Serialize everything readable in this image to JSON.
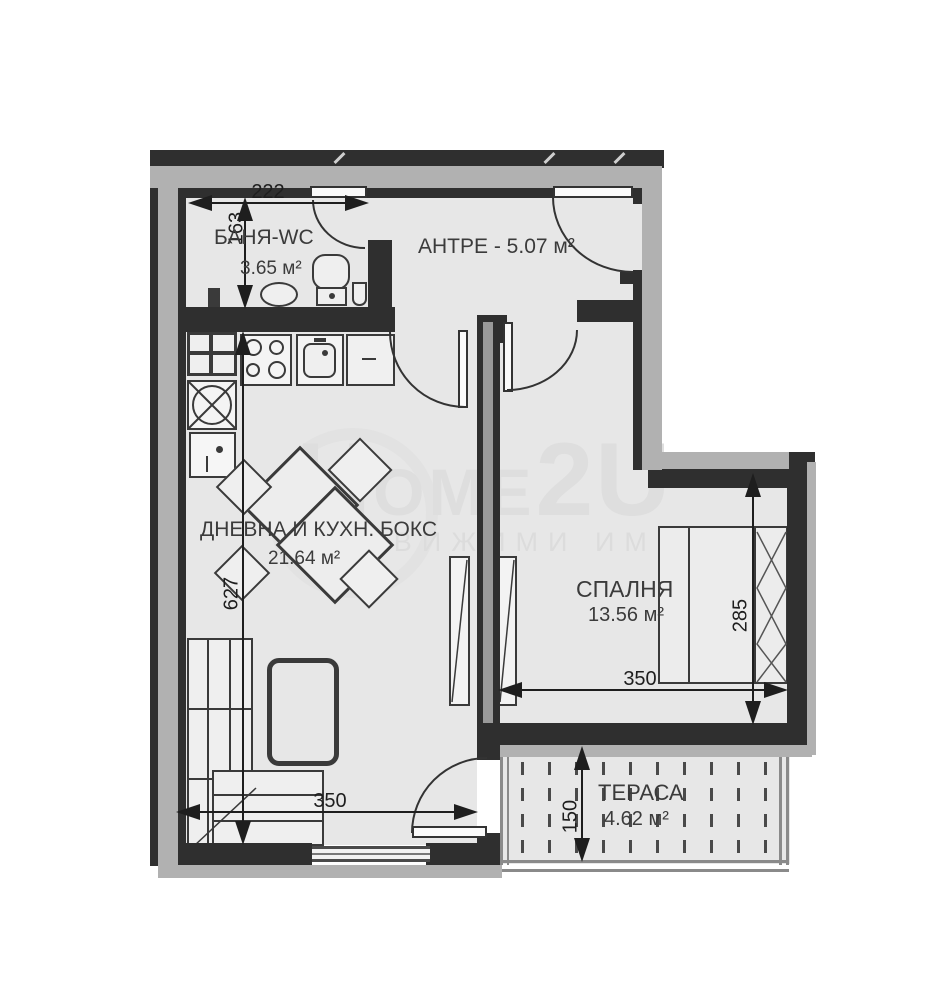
{
  "plan_title": "apartment-floor-plan",
  "rooms": {
    "bathroom": {
      "name": "БАНЯ-WC",
      "area": "3.65 м²"
    },
    "entry": {
      "name": "АНТРЕ - 5.07 м²"
    },
    "living": {
      "name": "ДНЕВНА И КУХН. БОКС",
      "area": "21.64 м²"
    },
    "bedroom": {
      "name": "СПАЛНЯ",
      "area": "13.56 м²"
    },
    "terrace": {
      "name": "ТЕРАСА",
      "area": "4.62 м²"
    }
  },
  "dimensions": {
    "bath_width": "222",
    "bath_height": "163",
    "living_height": "627",
    "bedroom_height": "285",
    "bedroom_width": "350",
    "living_width": "350",
    "terrace_depth": "150"
  },
  "watermark": {
    "brand_p1": "H",
    "brand_p2": "OME",
    "brand_p3": "2U",
    "tagline": "НЕДВИЖИМИ ИМОТИ"
  },
  "colors": {
    "wall": "#2f2f2f",
    "outer_band": "#b1b1b1",
    "floor": "#e7e7e7",
    "label_text": "#3b3b3b",
    "watermark": "#dedede"
  }
}
